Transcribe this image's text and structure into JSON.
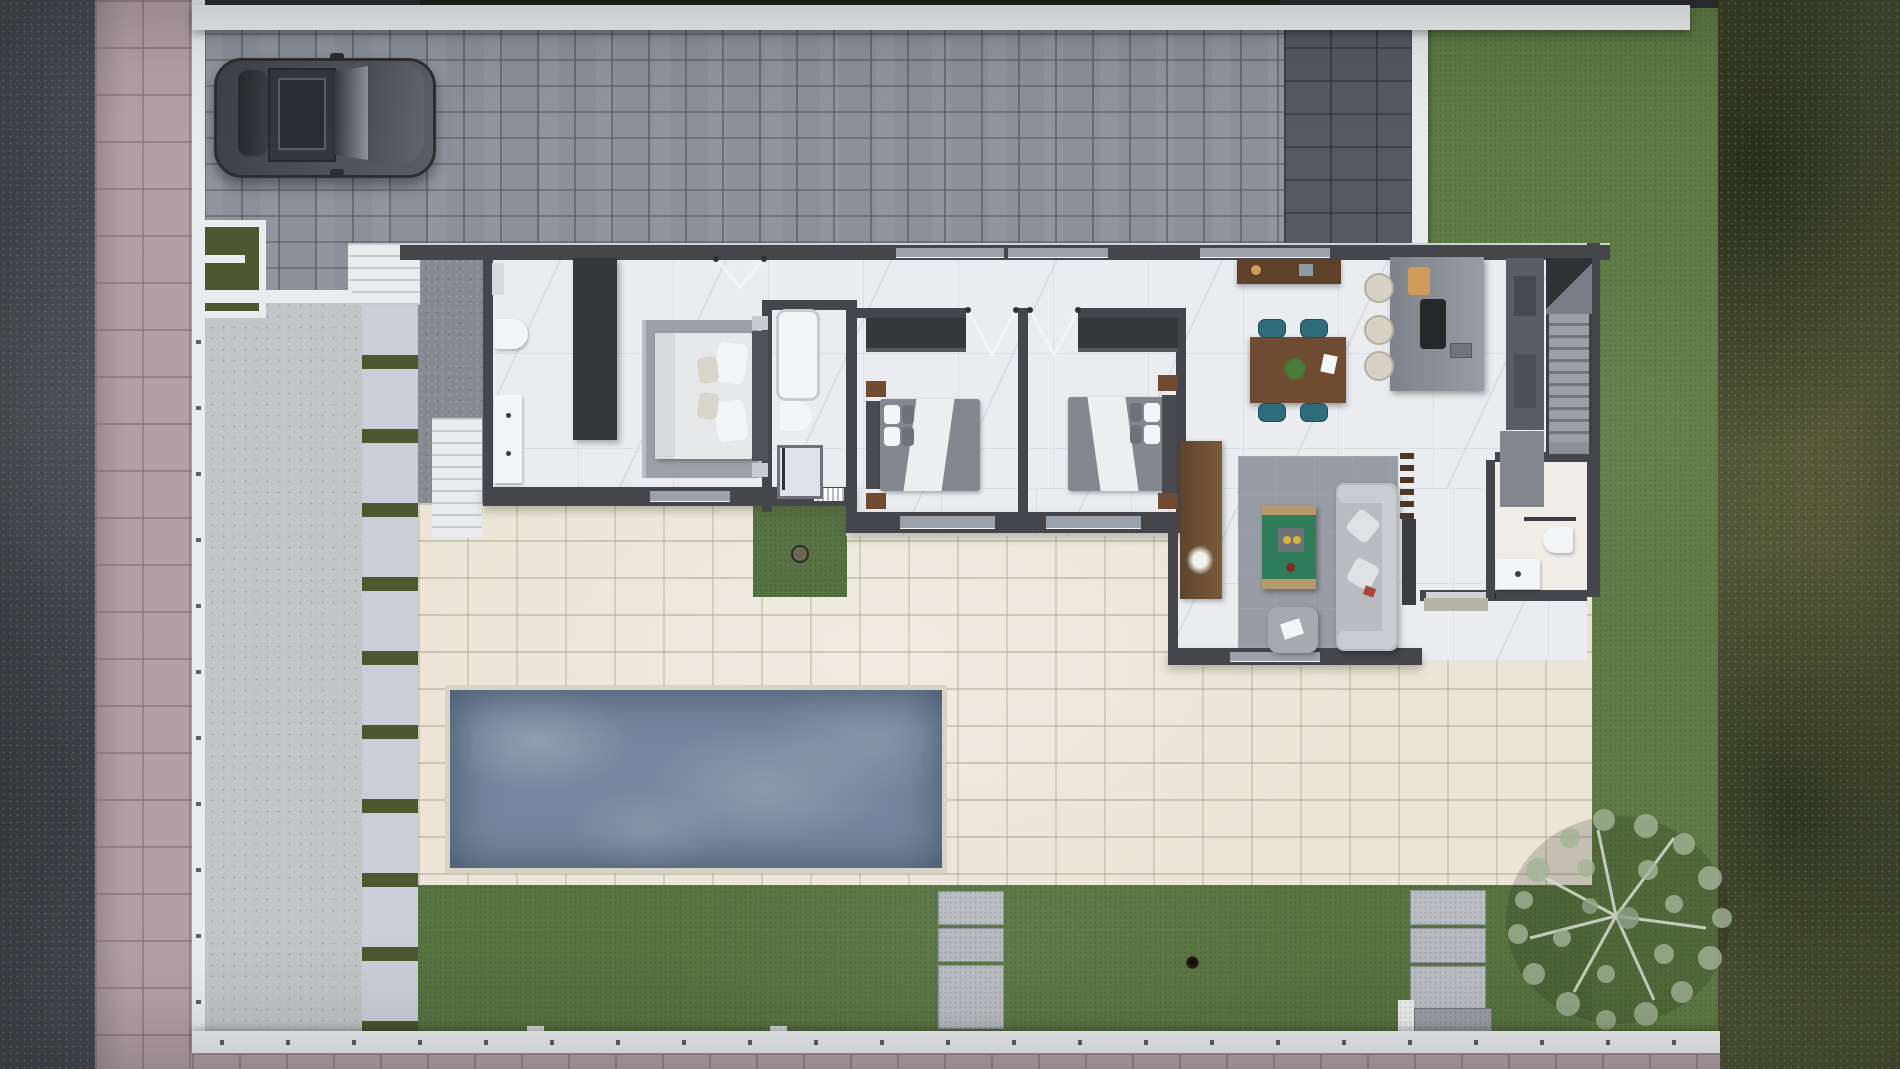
{
  "title": "Top-down 3D render of a single-storey villa plot with driveway, pool terrace and garden",
  "visible_text": [],
  "palette": {
    "road": "#46494e",
    "sidewalk": "#b2a0a6",
    "wallWhite": "#e9ecee",
    "paver": "#8b919b",
    "paverDark": "#555962",
    "gravel": "#c0c4c6",
    "gravelDark": "#868b92",
    "slab": "#c8cfd8",
    "grassStrip": "#4a5930",
    "patio": "#ebe5d8",
    "patioJoint": "#d8d3c5",
    "pool": "#75889f",
    "lawn": "#5e7b45",
    "lawnBack": "#587441",
    "lawnPatch": "#4f6b3a",
    "hedge": "#4c5334",
    "houseWall": "#45464b",
    "houseWallLight": "#9aa1aa",
    "marble": "#eaecf0",
    "wood": "#6f4c31",
    "woodLight": "#8a6a4a",
    "teal": "#2e6b7b",
    "tableGreen": "#2f7c5a",
    "sofa": "#b8bbc0",
    "sofaLight": "#c9ccd0",
    "rug": "#989ca4",
    "rugBedroom": "#9b9fa7",
    "bedWhite": "#e7e8ea",
    "comforter": "#83878e",
    "closet": "#36373b",
    "orange": "#d09a58",
    "stool": "#d9d2c4",
    "carBody": "#4b4e54",
    "carDark": "#303236",
    "carGlass": "#8b939d",
    "treeFoliage": "#a3b497",
    "white": "#f4f5f6"
  },
  "scene": {
    "site_areas": [
      "street-road",
      "street-sidewalk",
      "perimeter-wall",
      "paved-driveway",
      "dark-parking-pad",
      "entrance-gate",
      "gravel-side-court",
      "stepping-stone-path",
      "pool-terrace",
      "swimming-pool",
      "courtyard-grass-patch",
      "back-lawn",
      "side-lawn",
      "hedge-border",
      "garden-tree",
      "parked-car",
      "lawn-paver-steps",
      "rear-gate"
    ],
    "house": {
      "rooms": [
        "master-bathroom",
        "master-bedroom",
        "shared-bathroom",
        "bedroom-2",
        "bedroom-3",
        "hallway",
        "dining-area",
        "kitchen",
        "staircase",
        "guest-bathroom",
        "entry-hall",
        "living-room"
      ],
      "furniture": [
        "double-vanity",
        "toilet",
        "wardrobe",
        "master-bed",
        "bedroom-rug",
        "bathtub",
        "walk-in-shower",
        "closet-bedroom-2",
        "closet-bedroom-3",
        "double-bed-2",
        "double-bed-3",
        "nightstands",
        "sideboard",
        "dining-table",
        "dining-chairs",
        "potted-centerpiece",
        "kitchen-island",
        "cooktop",
        "cutting-board",
        "bar-stools",
        "tall-cabinets",
        "refrigerator",
        "stair-flight",
        "towel-rail",
        "guest-toilet",
        "guest-sink",
        "tv-console",
        "living-rug",
        "coffee-table",
        "sofa",
        "ottoman",
        "decor-ladder",
        "door-swings",
        "window-openings"
      ]
    }
  }
}
